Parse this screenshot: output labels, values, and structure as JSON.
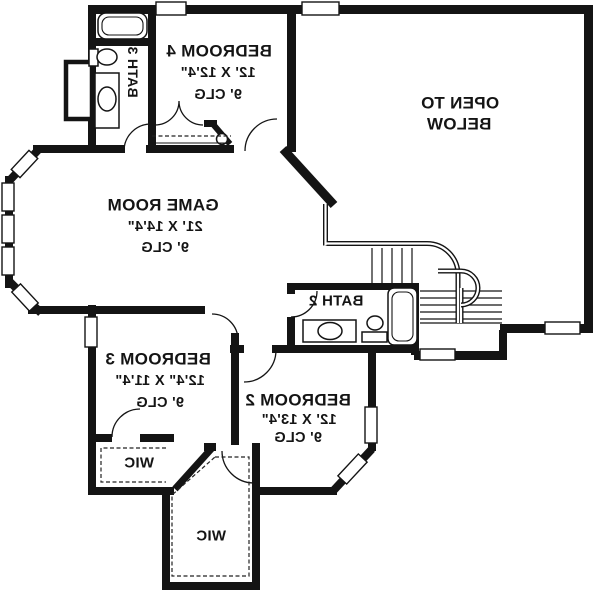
{
  "page": {
    "background": "#ffffff",
    "ink": "#141414"
  },
  "rooms": {
    "bedroom4": {
      "name": "BEDROOM 4",
      "dims": "12' X 12'4\"",
      "ceiling": "9' CLG"
    },
    "game_room": {
      "name": "GAME ROOM",
      "dims": "21' X 14'4\"",
      "ceiling": "9' CLG"
    },
    "open_to_below": {
      "line1": "OPEN TO",
      "line2": "BELOW"
    },
    "bedroom3": {
      "name": "BEDROOM 3",
      "dims": "12'4\" X 11'4\"",
      "ceiling": "9' CLG"
    },
    "bedroom2": {
      "name": "BEDROOM 2",
      "dims": "12' X 13'4\"",
      "ceiling": "9' CLG"
    },
    "bath2": {
      "name": "BATH 2"
    },
    "bath3": {
      "name": "BATH 3"
    },
    "wic_bedroom3": {
      "name": "WIC"
    },
    "wic_bedroom2": {
      "name": "WIC"
    }
  }
}
